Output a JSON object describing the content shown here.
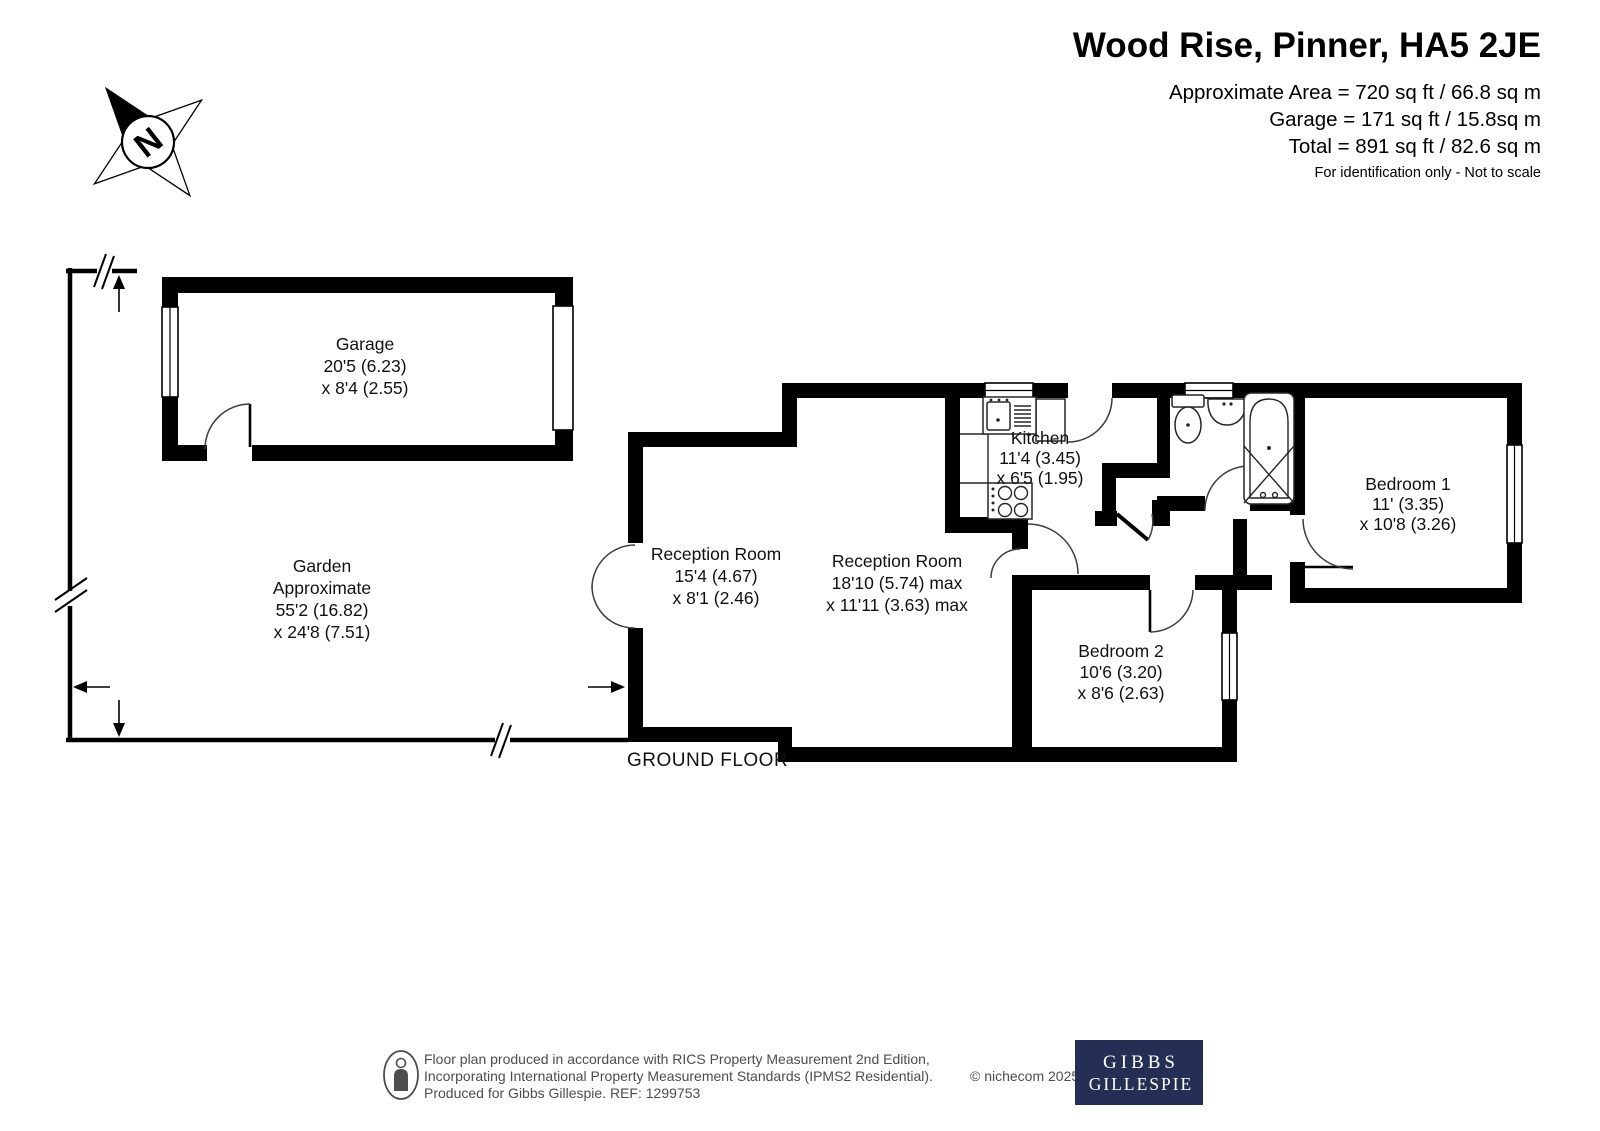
{
  "header": {
    "title": "Wood Rise, Pinner, HA5 2JE",
    "area_lines": [
      "Approximate Area = 720 sq ft / 66.8 sq m",
      "Garage = 171 sq ft / 15.8sq m",
      "Total = 891 sq ft / 82.6 sq m"
    ],
    "disclaimer": "For identification only - Not to scale"
  },
  "compass": {
    "north_label": "N"
  },
  "floor_label": "GROUND FLOOR",
  "rooms": [
    {
      "name": "garage",
      "lines": [
        "Garage",
        "20'5 (6.23)",
        "x 8'4 (2.55)"
      ]
    },
    {
      "name": "garden",
      "lines": [
        "Garden",
        "Approximate",
        "55'2 (16.82)",
        "x 24'8 (7.51)"
      ]
    },
    {
      "name": "reception-room-1",
      "lines": [
        "Reception Room",
        "15'4 (4.67)",
        "x 8'1 (2.46)"
      ]
    },
    {
      "name": "reception-room-2",
      "lines": [
        "Reception Room",
        "18'10 (5.74) max",
        "x 11'11 (3.63) max"
      ]
    },
    {
      "name": "kitchen",
      "lines": [
        "Kitchen",
        "11'4 (3.45)",
        "x 6'5 (1.95)"
      ]
    },
    {
      "name": "bedroom-1",
      "lines": [
        "Bedroom 1",
        "11' (3.35)",
        "x 10'8 (3.26)"
      ]
    },
    {
      "name": "bedroom-2",
      "lines": [
        "Bedroom 2",
        "10'6 (3.20)",
        "x 8'6 (2.63)"
      ]
    }
  ],
  "footer": {
    "lines": [
      "Floor plan produced in accordance with RICS Property Measurement 2nd Edition,",
      "Incorporating International Property Measurement Standards (IPMS2 Residential).",
      "Produced for Gibbs Gillespie.   REF:  1299753"
    ],
    "copyright": "© nichecom 2025.",
    "logo_line1": "GIBBS",
    "logo_line2": "GILLESPIE"
  },
  "colors": {
    "wall": "#000000",
    "logo_bg": "#252f55",
    "footer_text": "#4d4d4d"
  }
}
